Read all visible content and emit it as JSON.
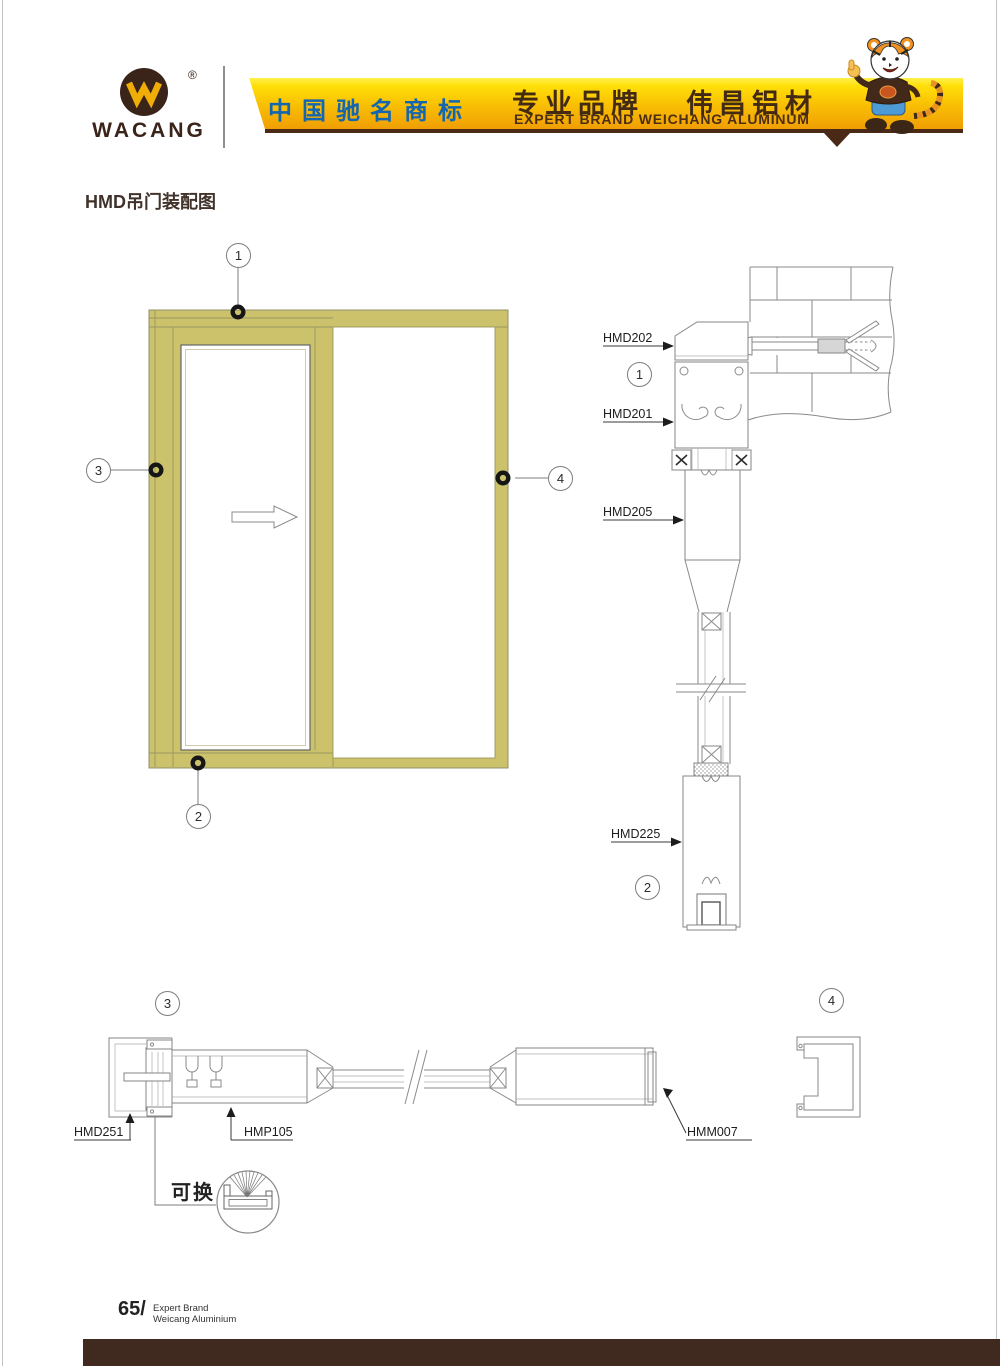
{
  "header": {
    "brand": "WACANG",
    "registered_mark": "®",
    "banner_cn_left": "中国驰名商标",
    "banner_cn_right_a": "专业品牌",
    "banner_cn_right_b": "伟昌铝材",
    "banner_en": "EXPERT BRAND WEICHANG ALUMINUM"
  },
  "page_title": "HMD吊门装配图",
  "callouts": {
    "c1": "1",
    "c2": "2",
    "c3": "3",
    "c4": "4"
  },
  "part_labels": {
    "hmd202": "HMD202",
    "hmd201": "HMD201",
    "hmd205": "HMD205",
    "hmd225": "HMD225",
    "hmd251": "HMD251",
    "hmp105": "HMP105",
    "hmm007": "HMM007"
  },
  "notes": {
    "replaceable": "可换"
  },
  "footer": {
    "page_number": "65/",
    "brand_line1": "Expert Brand",
    "brand_line2": "Weicang Aluminium"
  },
  "colors": {
    "frame_olive": "#cbc26b",
    "banner_blue_text": "#1566b0",
    "brand_brown": "#3a241a",
    "footer_bar": "#40291e"
  }
}
